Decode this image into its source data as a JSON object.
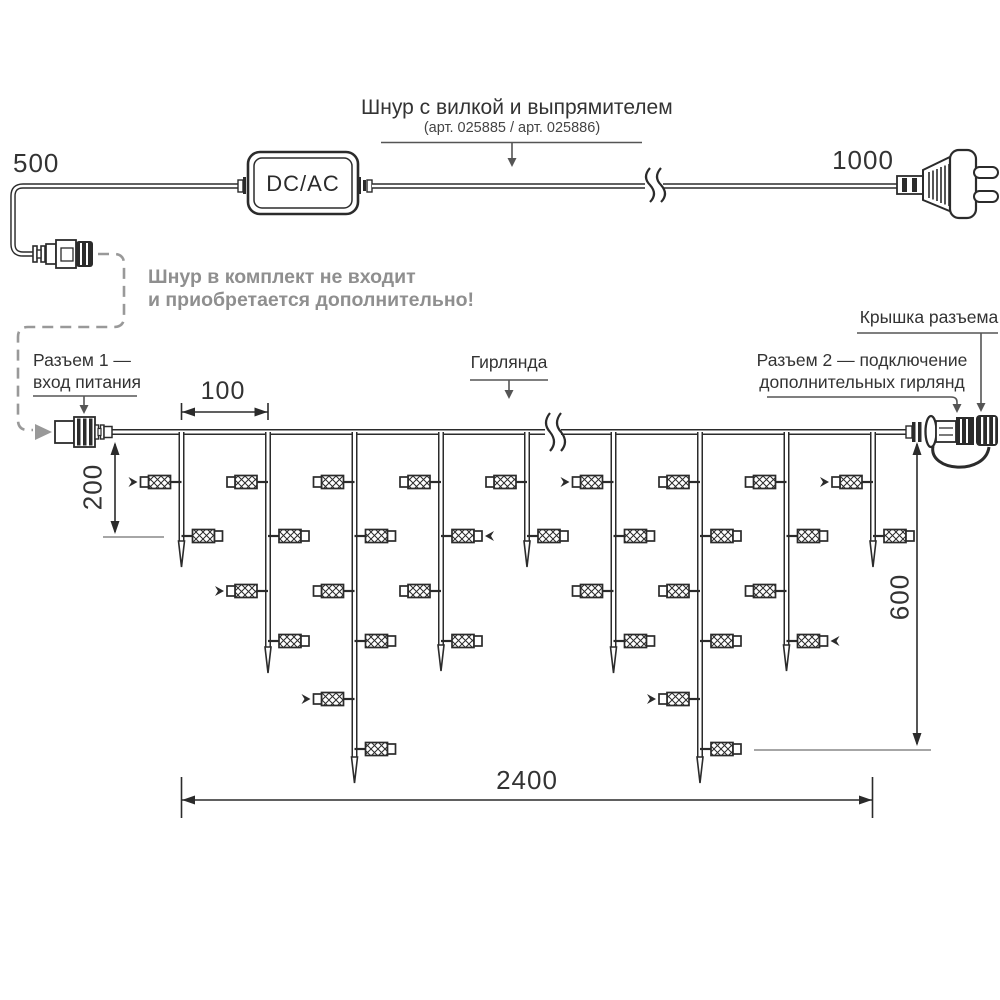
{
  "colors": {
    "line": "#2b2b2b",
    "text": "#333333",
    "muted": "#8f8f8f",
    "leader": "#555555",
    "refline": "#888888"
  },
  "power_cord": {
    "title": "Шнур с вилкой и выпрямителем",
    "subtitle": "(арт. 025885 / арт. 025886)",
    "left_length": "500",
    "right_length": "1000",
    "adapter_label": "DC/AC",
    "note_line1": "Шнур в комплект не входит",
    "note_line2": "и приобретается дополнительно!"
  },
  "garland_section": {
    "connector1_line1": "Разъем 1 —",
    "connector1_line2": "вход питания",
    "garland_label": "Гирлянда",
    "connector2_line1": "Разъем 2 — подключение",
    "connector2_line2": "дополнительных гирлянд",
    "cap_label": "Крышка разъема",
    "dim_spacing": "100",
    "dim_short_drop": "200",
    "dim_height": "600",
    "dim_length": "2400"
  },
  "garland": {
    "wire_y": 432,
    "drop_xs": [
      181.5,
      268,
      354.5,
      441,
      527,
      613.5,
      700,
      786.5,
      873
    ],
    "drop_tips": [
      567,
      673,
      783,
      671,
      567,
      673,
      783,
      671,
      567
    ],
    "lamp_rows": [
      482,
      536,
      591,
      641,
      699,
      749
    ],
    "lamps_per_drop": [
      2,
      4,
      6,
      4,
      2,
      4,
      6,
      4,
      2
    ],
    "blink_arrows": [
      [
        0,
        0
      ],
      [
        1,
        2
      ],
      [
        2,
        4
      ],
      [
        3,
        1
      ],
      [
        5,
        0
      ],
      [
        6,
        4
      ],
      [
        7,
        3
      ],
      [
        8,
        0
      ]
    ]
  }
}
